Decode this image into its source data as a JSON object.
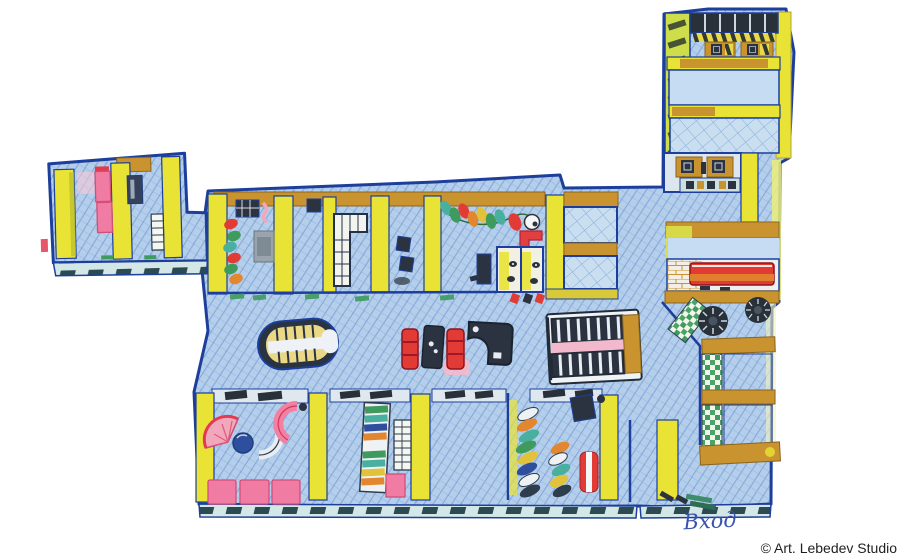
{
  "artwork": {
    "kind": "watercolor axonometric floor plan of an office",
    "width": 900,
    "height": 558,
    "background": "#ffffff"
  },
  "labels": {
    "entrance": "Вход",
    "credit": "© Art. Lebedev Studio"
  },
  "palette": {
    "floor_blue": "#b5cfeb",
    "hatch_blue": "#4d80cb",
    "outline_navy": "#1d3f9b",
    "wall_yellow": "#e8e335",
    "wall_olive": "#b9bc2b",
    "wall_tan": "#c9942f",
    "furniture_pink": "#f07ba3",
    "furniture_red": "#e23a35",
    "furniture_orange": "#e2872f",
    "furniture_charcoal": "#2b3340",
    "accent_teal": "#49b0a0",
    "accent_green": "#3f9a5e",
    "glass_teal": "#d3e7e6",
    "desk_cream": "#ead887",
    "shelf_pink": "#f2b9cc",
    "text_blue": "#3853ae",
    "text_dark": "#1f1f1f"
  },
  "floorplan": {
    "entrance_side": "bottom",
    "wings": [
      {
        "name": "left-wing",
        "rooms": [
          "office-with-pink-desks",
          "office-with-cabinet-and-shelf"
        ]
      },
      {
        "name": "top-row",
        "rooms": [
          "office-with-colored-chairs-and-desk",
          "empty-office",
          "office-with-grid-tables",
          "small-office-with-monitors",
          "room-with-hanging-chair-garland",
          "restroom-stalls",
          "double-room-block"
        ]
      },
      {
        "name": "central-hall",
        "furniture": [
          "oval-reception-desk",
          "red-sofa-pair-with-table",
          "corner-desk",
          "bookshelf"
        ]
      },
      {
        "name": "bottom-row",
        "rooms": [
          "lounge-with-fan-table-and-sofas",
          "office-with-striped-shelf",
          "empty-office",
          "office-with-chair-stacks",
          "entrance-room"
        ]
      },
      {
        "name": "right-wing",
        "rooms": [
          "open-space-with-monitor-desks",
          "empty-room",
          "grid-floor-room",
          "computer-room",
          "red-sofa-lounge",
          "stair-corridor-with-shelves"
        ]
      }
    ]
  }
}
